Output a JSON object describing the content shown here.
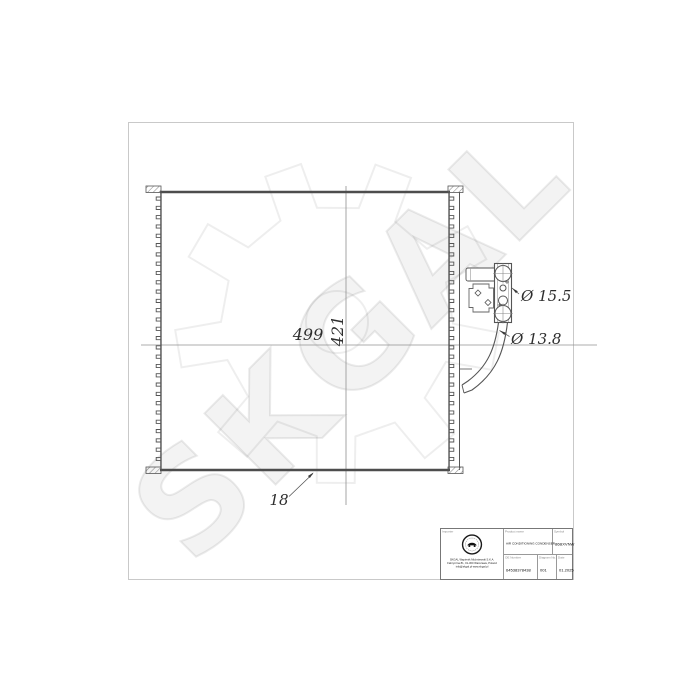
{
  "watermark": "SKGAL",
  "dimensions": {
    "width": "499",
    "height": "421",
    "depth": "18",
    "port_large": "Ø 15.5",
    "port_small": "Ø 13.8"
  },
  "title_block": {
    "importer_label": "Importer",
    "company_lines": [
      "SKGAL Wapienik Michniewski S.K.A.",
      "Fabryczna 81, 01-300 Warszawa, Poland",
      "info@skgal.pl  www.skgal.pl"
    ],
    "product_label": "Product name",
    "product_value": "AIR CONDITIONING CONDENSER",
    "symbol_label": "Symbol",
    "symbol_value": "86BXVNW",
    "oe_label": "OE Number",
    "oe_value": "64538378438",
    "diagram_label": "Diagram No.",
    "diagram_value": "001",
    "date_label": "Date",
    "date_value": "01.2025"
  },
  "colors": {
    "line": "#4d4d4d",
    "dim_line": "#909090",
    "frame": "#c9c9c9",
    "watermark": "#ebebeb"
  }
}
